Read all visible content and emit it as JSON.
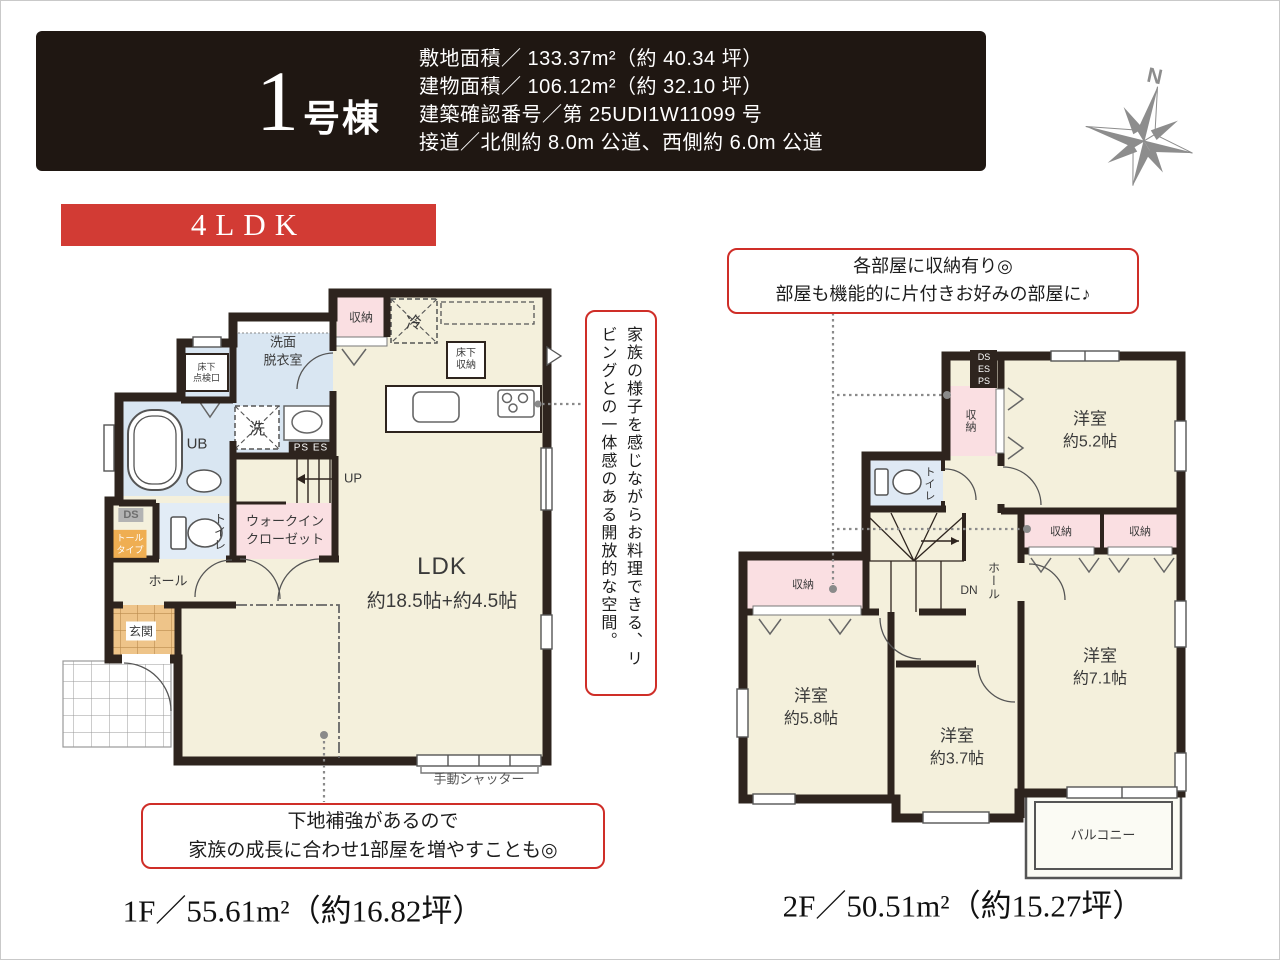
{
  "colors": {
    "accent_red": "#d23b34",
    "callout_border_red": "#cf2e28",
    "wall_dark": "#2e241e",
    "floor_cream": "#f4f0dc",
    "wet_area_blue": "#d9e6f2",
    "storage_pink": "#fadfe2",
    "entrance_tile_orange": "#eec489",
    "header_bg": "#1f1712",
    "compass_gray": "#8d8d8d"
  },
  "header": {
    "building_number": "1",
    "building_unit": "号棟",
    "specs": [
      "敷地面積／ 133.37m²（約 40.34 坪）",
      "建物面積／ 106.12m²（約 32.10 坪）",
      "建築確認番号／第 25UDI1W11099 号",
      "接道／北側約 8.0m 公道、西側約 6.0m 公道"
    ]
  },
  "compass": {
    "north": "N"
  },
  "badge": {
    "text": "4LDK"
  },
  "callouts": {
    "kitchen_vertical": "家族の様子を感じながらお料理できる、リビングとの一体感のある開放的な空間。",
    "reinforce_line1": "下地補強があるので",
    "reinforce_line2": "家族の成長に合わせ1部屋を増やすことも◎",
    "storage_line1": "各部屋に収納有り◎",
    "storage_line2": "部屋も機能的に片付きお好みの部屋に♪"
  },
  "floor1": {
    "area_label": "1F／55.61m²（約16.82坪）",
    "labels": {
      "storage": "収納",
      "fridge": "冷",
      "underfloor_storage_l1": "床下",
      "underfloor_storage_l2": "収納",
      "washroom_l1": "洗面",
      "washroom_l2": "脱衣室",
      "hatch_l1": "床下",
      "hatch_l2": "点検口",
      "unit_bath": "UB",
      "washer": "洗",
      "ps_es": "PS ES",
      "up": "UP",
      "ds": "DS",
      "tall_l1": "トール",
      "tall_l2": "タイプ",
      "toilet": "トイレ",
      "wic_l1": "ウォークイン",
      "wic_l2": "クローゼット",
      "hall": "ホール",
      "entrance": "玄関",
      "ldk_l1": "LDK",
      "ldk_l2": "約18.5帖+約4.5帖",
      "shutter": "手動シャッター"
    }
  },
  "floor2": {
    "area_label": "2F／50.51m²（約15.27坪）",
    "labels": {
      "ds": "DS",
      "es": "ES",
      "ps": "PS",
      "storage_top": "収納",
      "storage_mid1": "収納",
      "storage_mid2": "収納",
      "storage_left": "収納",
      "room52_l1": "洋室",
      "room52_l2": "約5.2帖",
      "room58_l1": "洋室",
      "room58_l2": "約5.8帖",
      "room37_l1": "洋室",
      "room37_l2": "約3.7帖",
      "room71_l1": "洋室",
      "room71_l2": "約7.1帖",
      "toilet": "トイレ",
      "dn": "DN",
      "hall": "ホール",
      "balcony": "バルコニー"
    }
  }
}
